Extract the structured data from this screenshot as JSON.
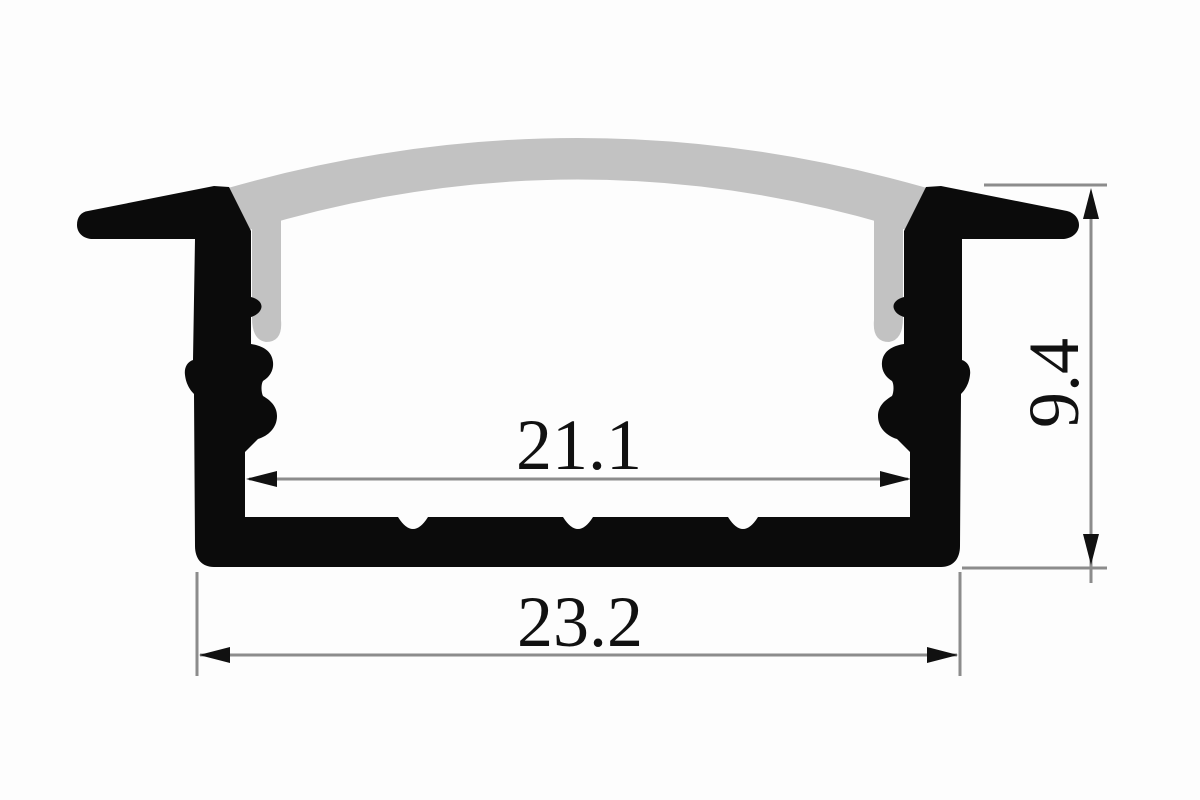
{
  "diagram": {
    "type": "technical cross-section drawing",
    "subject": "recessed LED strip aluminum profile with arched diffuser cover",
    "dimensions": {
      "inner_width": {
        "label": "21.1",
        "orientation": "horizontal",
        "position": "inner channel width"
      },
      "outer_width": {
        "label": "23.2",
        "orientation": "horizontal",
        "position": "overall base width"
      },
      "height": {
        "label": "9.4",
        "orientation": "vertical",
        "position": "overall profile height"
      }
    },
    "colors": {
      "profile_body": "#0b0b0b",
      "diffuser": "#c2c2c2",
      "dimension_line": "#8c8c8c",
      "arrowhead": "#111111",
      "text": "#111111",
      "background": "#fdfdfd"
    }
  }
}
